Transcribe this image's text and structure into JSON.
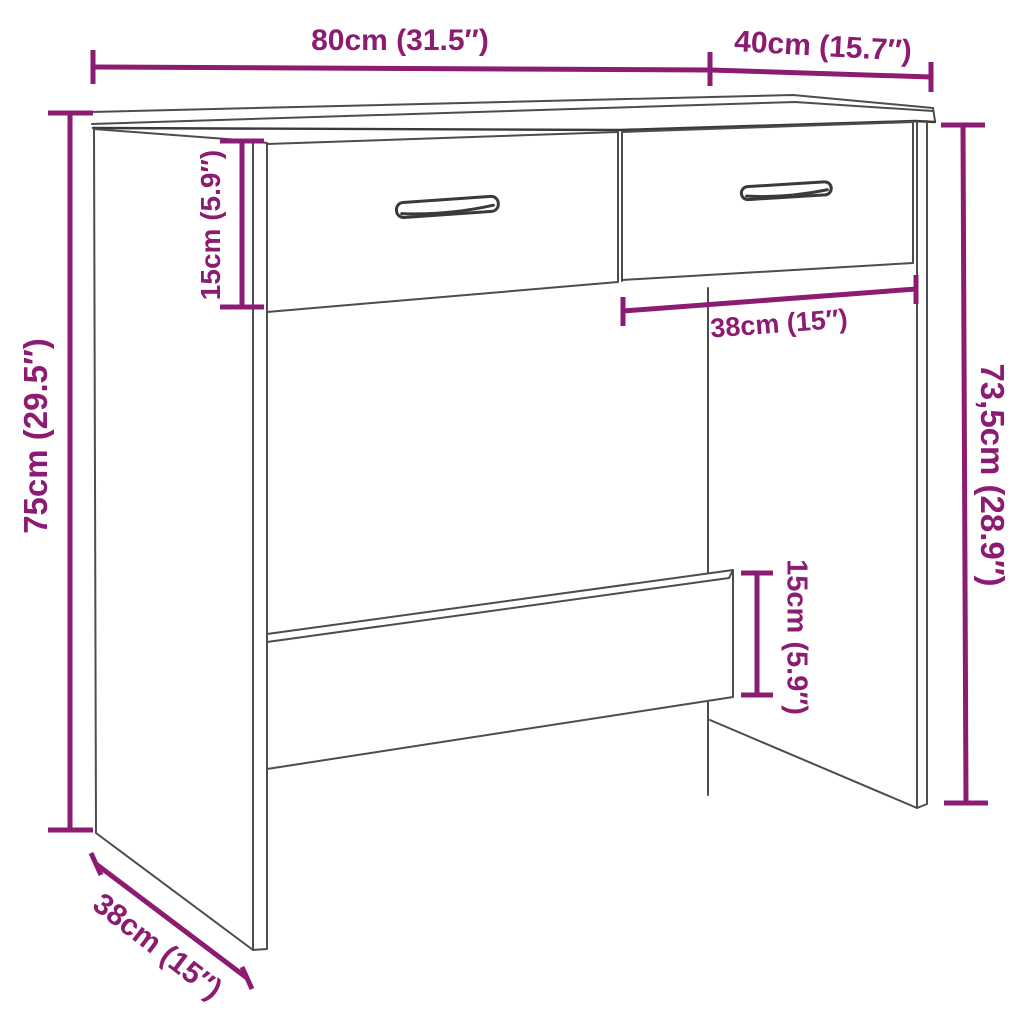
{
  "diagram": {
    "subject": "desk-with-two-drawers-dimension-diagram",
    "background_color": "#ffffff",
    "dimension_color": "#8b1c72",
    "outline_color": "#4d4d4d",
    "labels": {
      "top_width": "80cm (31.5″)",
      "top_depth": "40cm (15.7″)",
      "left_height": "75cm (29.5″)",
      "drawer_height": "15cm (5.9″)",
      "drawer_width": "38cm (15″)",
      "right_height": "73,5cm (28.9″)",
      "bottom_depth": "38cm (15″)",
      "stretcher_height": "15cm (5.9″)"
    }
  }
}
